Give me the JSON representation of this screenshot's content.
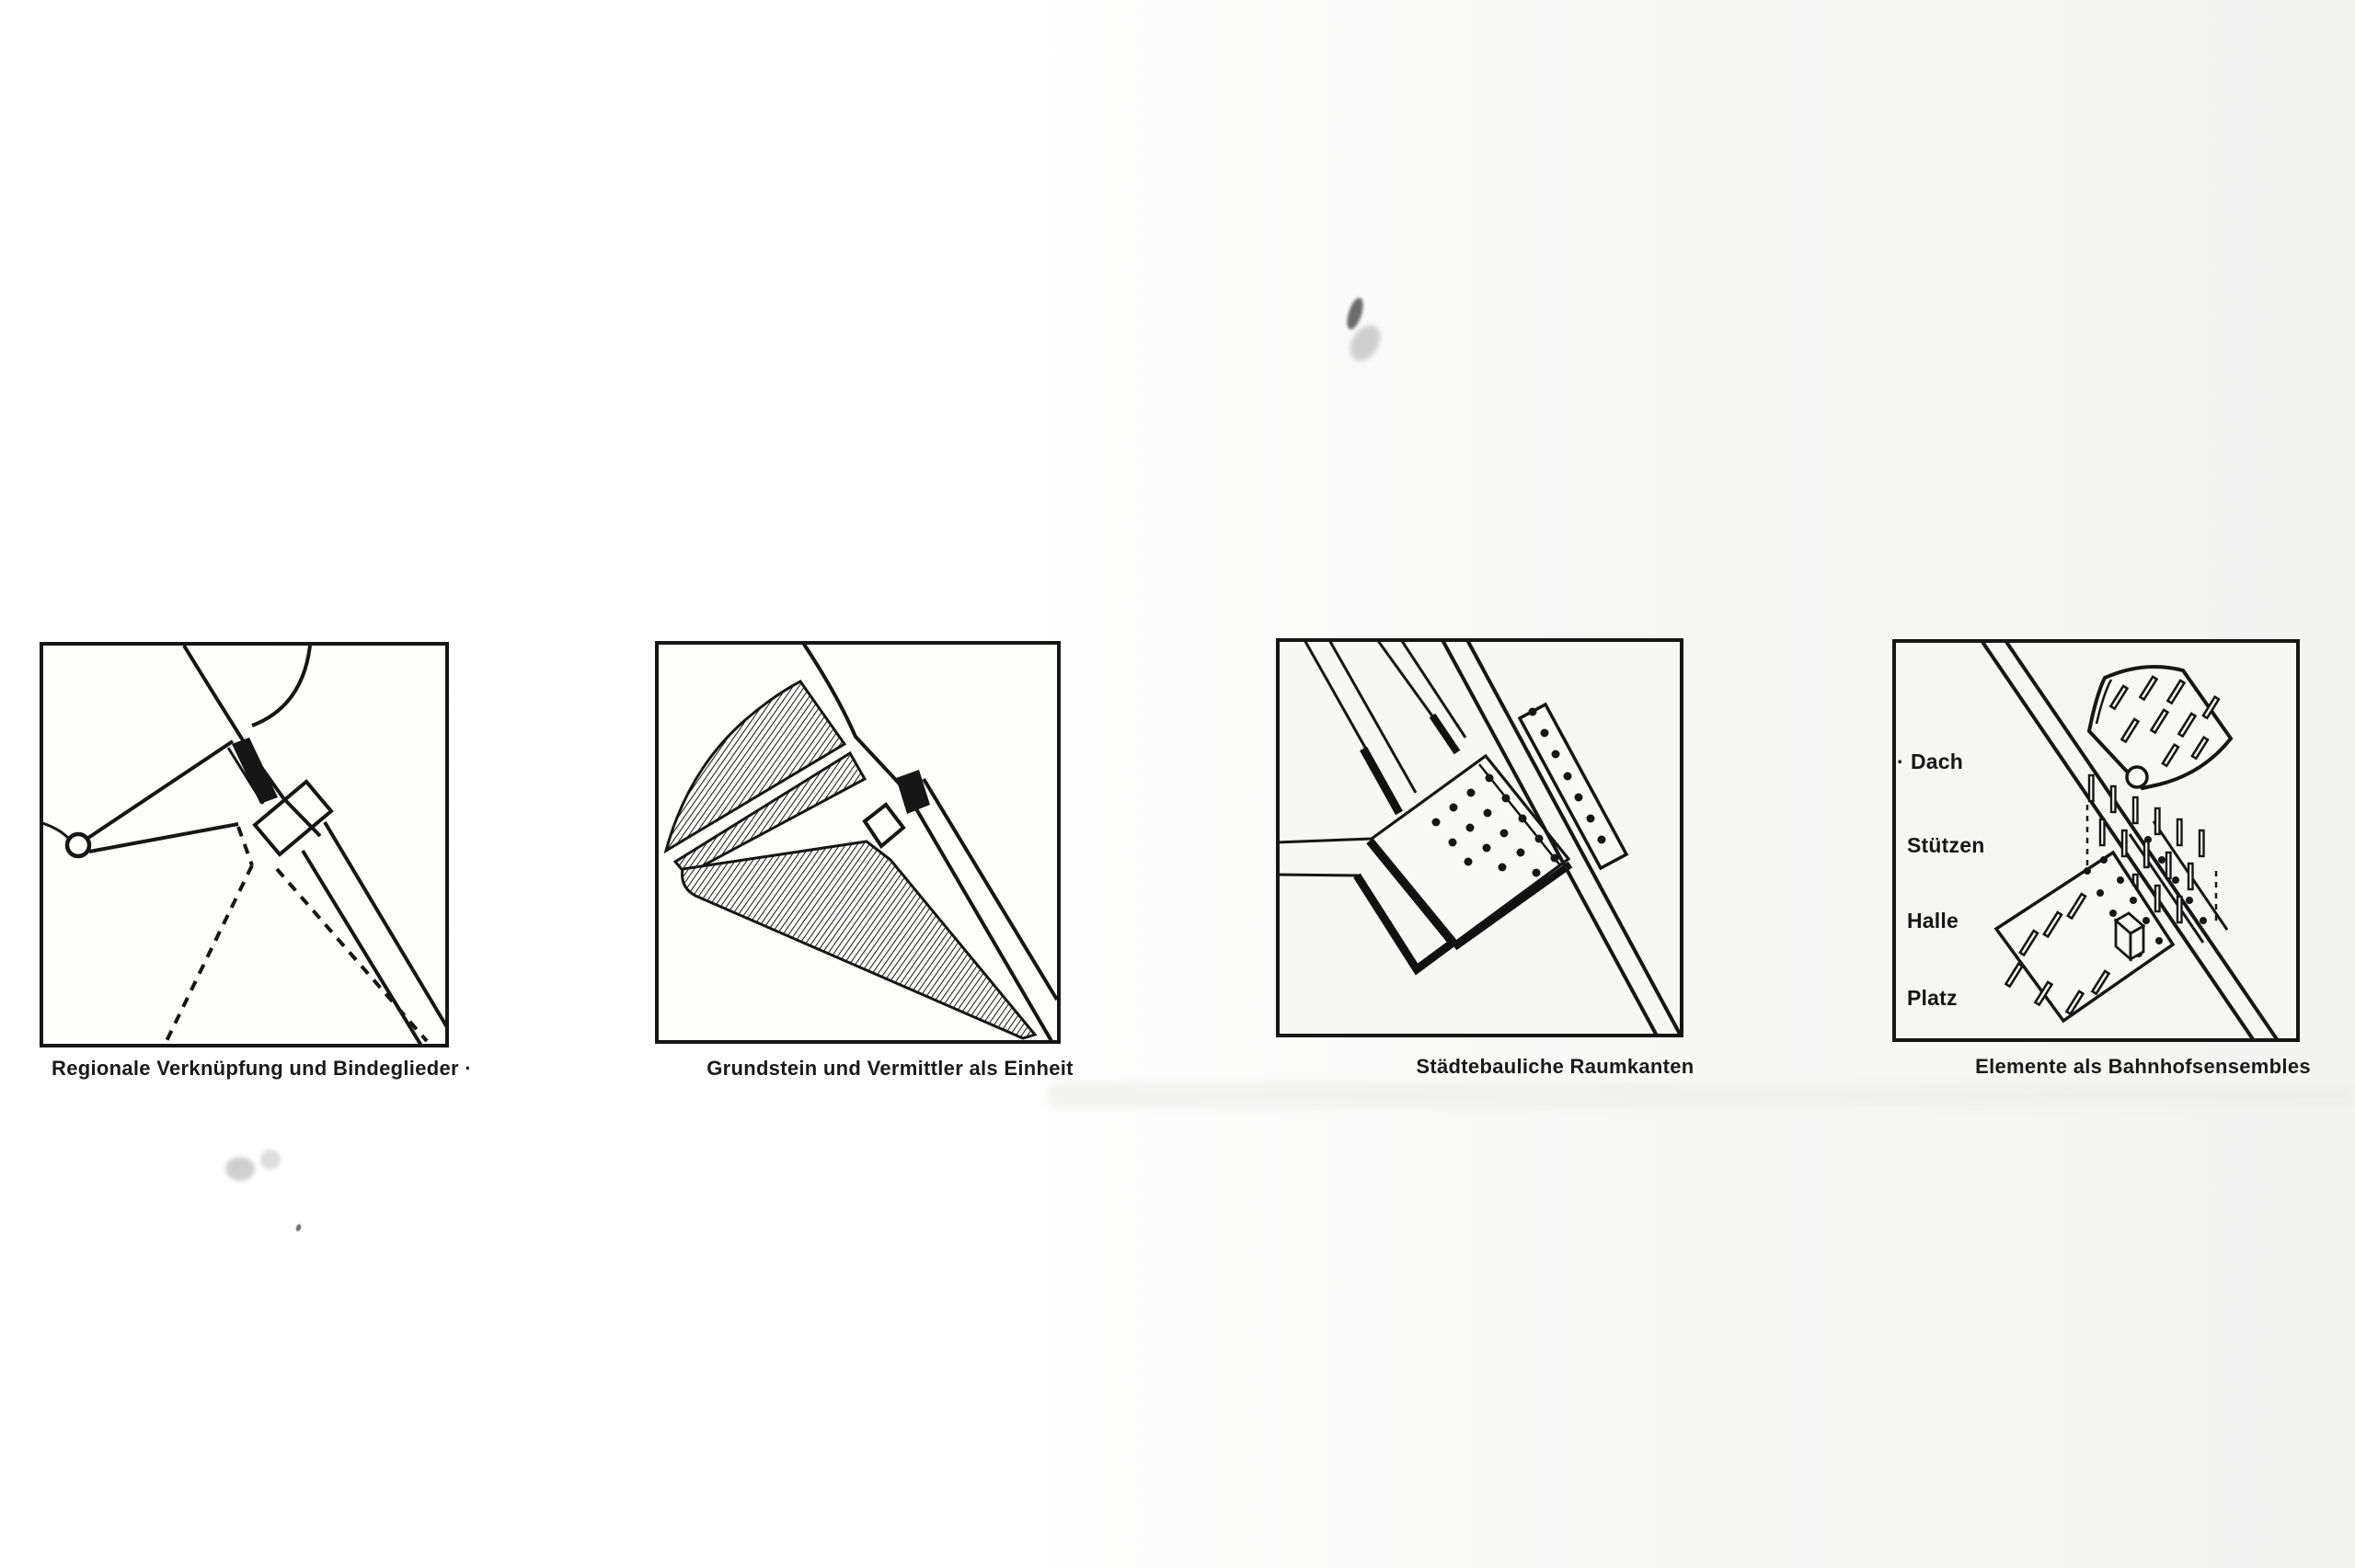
{
  "figures": [
    {
      "caption": "Regionale Verknüpfung und Bindeglieder ·"
    },
    {
      "caption": "Grundstein und Vermittler als Einheit"
    },
    {
      "caption": "Städtebauliche Raumkanten"
    },
    {
      "caption": "Elemente als Bahnhofsensembles",
      "labels": {
        "bullet": "·",
        "items": [
          "Dach",
          "Stützen",
          "Halle",
          "Platz"
        ]
      }
    }
  ],
  "colors": {
    "ink": "#161616",
    "paper": "#fdfdfc"
  }
}
